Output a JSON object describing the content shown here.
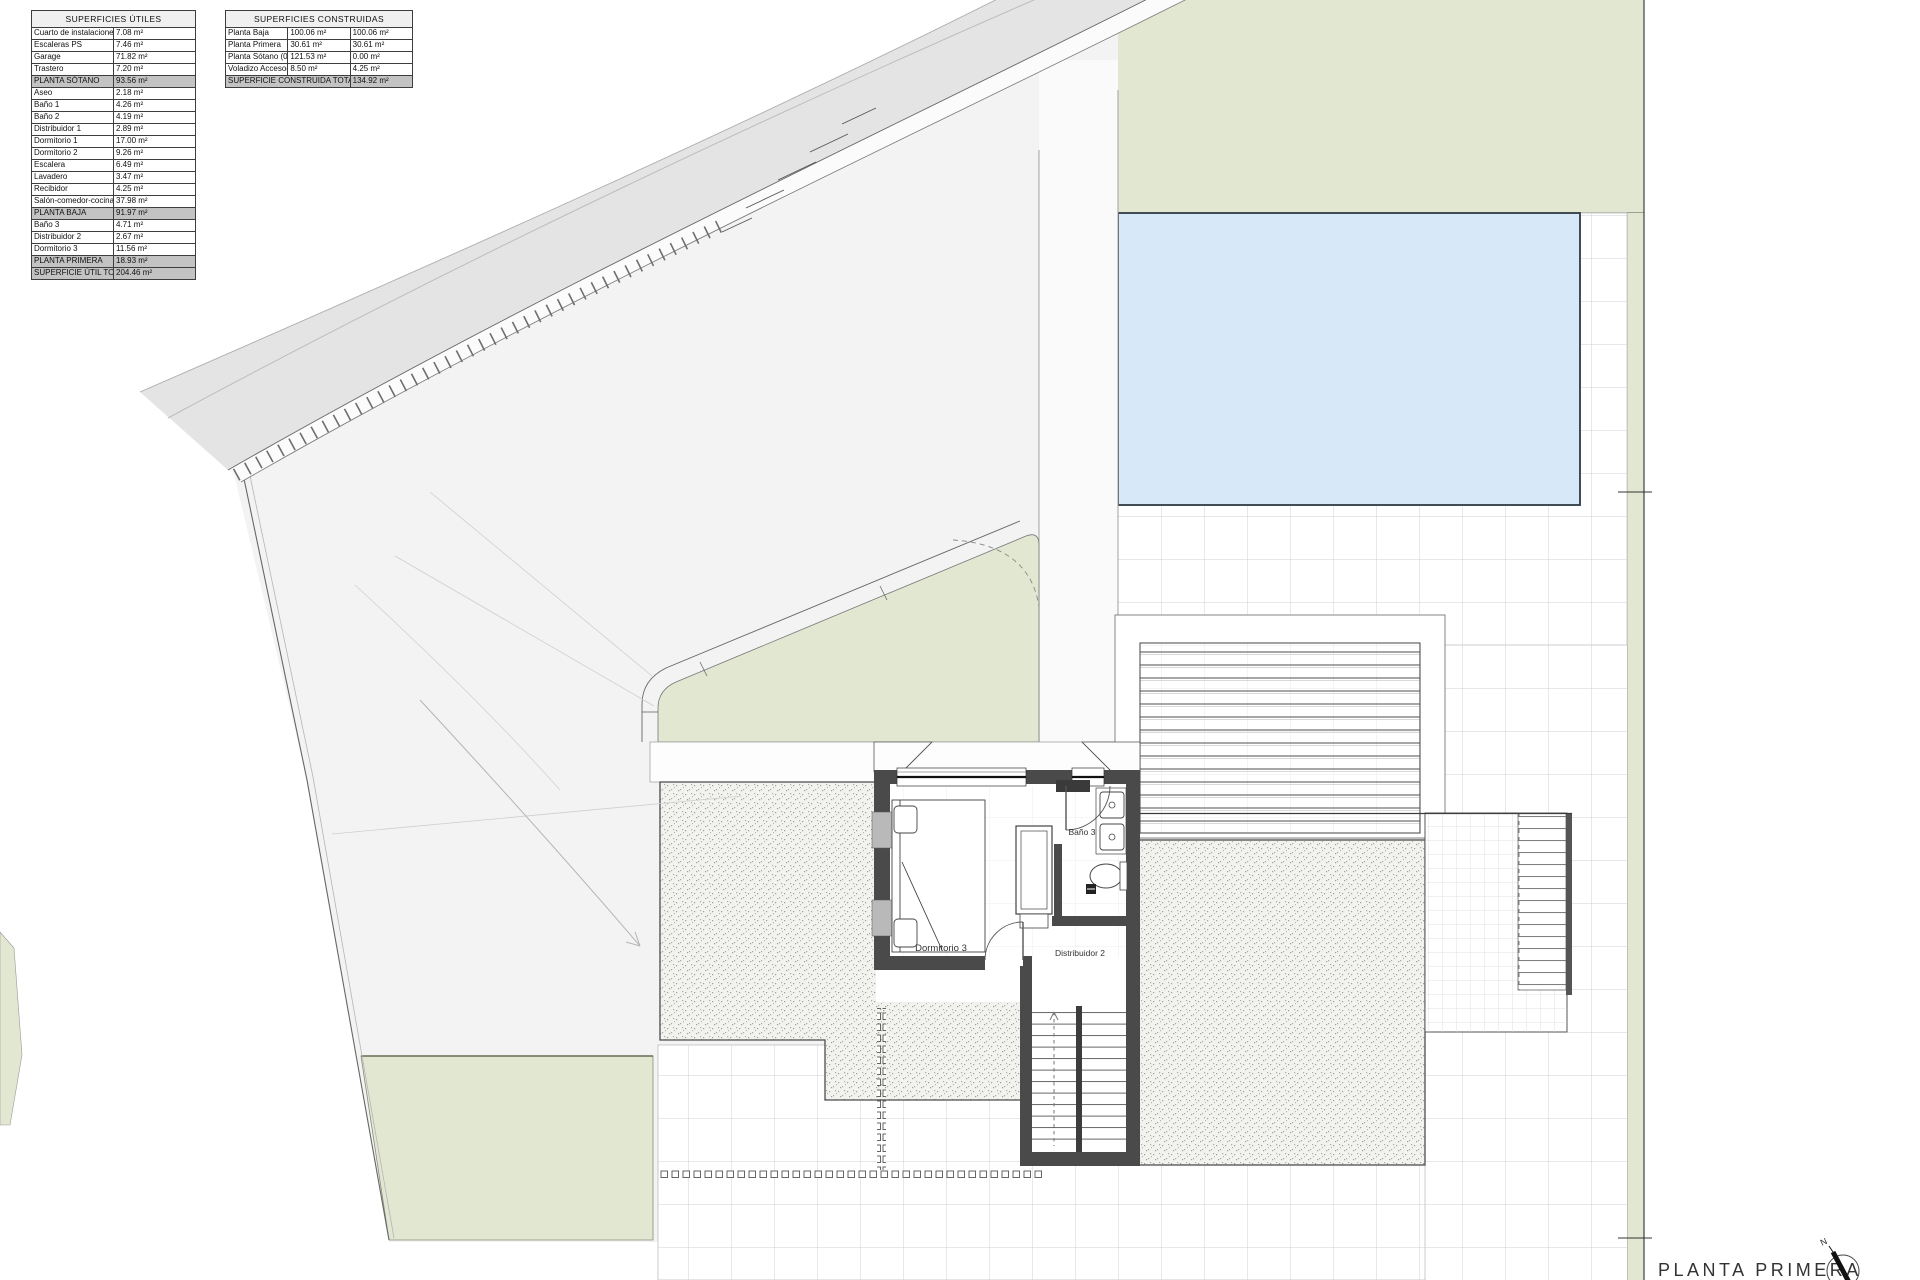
{
  "tables": {
    "utiles": {
      "title": "SUPERFICIES ÚTILES",
      "rows": [
        {
          "label": "Cuarto de instalaciones",
          "value": "7.08 m²",
          "type": "normal"
        },
        {
          "label": "Escaleras PS",
          "value": "7.46 m²",
          "type": "normal"
        },
        {
          "label": "Garage",
          "value": "71.82 m²",
          "type": "normal"
        },
        {
          "label": "Trastero",
          "value": "7.20 m²",
          "type": "normal"
        },
        {
          "label": "PLANTA SÓTANO",
          "value": "93.56 m²",
          "type": "section"
        },
        {
          "label": "Aseo",
          "value": "2.18 m²",
          "type": "normal"
        },
        {
          "label": "Baño 1",
          "value": "4.26 m²",
          "type": "normal"
        },
        {
          "label": "Baño 2",
          "value": "4.19 m²",
          "type": "normal"
        },
        {
          "label": "Distribuidor 1",
          "value": "2.89 m²",
          "type": "normal"
        },
        {
          "label": "Dormitorio 1",
          "value": "17.00 m²",
          "type": "normal"
        },
        {
          "label": "Dormitorio 2",
          "value": "9.26 m²",
          "type": "normal"
        },
        {
          "label": "Escalera",
          "value": "6.49 m²",
          "type": "normal"
        },
        {
          "label": "Lavadero",
          "value": "3.47 m²",
          "type": "normal"
        },
        {
          "label": "Recibidor",
          "value": "4.25 m²",
          "type": "normal"
        },
        {
          "label": "Salón-comedor-cocina",
          "value": "37.98 m²",
          "type": "normal"
        },
        {
          "label": "PLANTA BAJA",
          "value": "91.97 m²",
          "type": "section"
        },
        {
          "label": "Baño 3",
          "value": "4.71 m²",
          "type": "normal"
        },
        {
          "label": "Distribuidor 2",
          "value": "2.67 m²",
          "type": "normal"
        },
        {
          "label": "Dormitorio 3",
          "value": "11.56 m²",
          "type": "normal"
        },
        {
          "label": "PLANTA PRIMERA",
          "value": "18.93 m²",
          "type": "section"
        },
        {
          "label": "SUPERFICIE ÚTIL TOTAL",
          "value": "204.46 m²",
          "type": "total"
        }
      ]
    },
    "construidas": {
      "title": "SUPERFICIES CONSTRUIDAS",
      "rows": [
        {
          "label": "Planta Baja",
          "value1": "100.06 m²",
          "value2": "100.06 m²"
        },
        {
          "label": "Planta Primera",
          "value1": "30.61 m²",
          "value2": "30.61 m²"
        },
        {
          "label": "Planta Sótano (0%)",
          "value1": "121.53 m²",
          "value2": "0.00 m²"
        },
        {
          "label": "Voladizo Acceso(50%)",
          "value1": "8.50 m²",
          "value2": "4.25 m²"
        }
      ],
      "total": {
        "label": "SUPERFICIE CONSTRUIDA TOTAL",
        "value": "134.92 m²"
      }
    }
  },
  "plan": {
    "rooms": {
      "dormitorio3": "Dormitorio 3",
      "bano3": "Baño 3",
      "distribuidor2": "Distribuidor 2"
    },
    "title": "PLANTA PRIMERA",
    "compass_label": "N"
  },
  "colors": {
    "garden_green": "#e2e7d2",
    "pool_blue": "#d7e9f8",
    "road_gray": "#e4e4e4",
    "driveway_gray": "#f3f3f3",
    "wall_dark": "#4a4a4a",
    "tile_line": "#ccd1d9",
    "table_section_gray": "#c3c3c3"
  }
}
